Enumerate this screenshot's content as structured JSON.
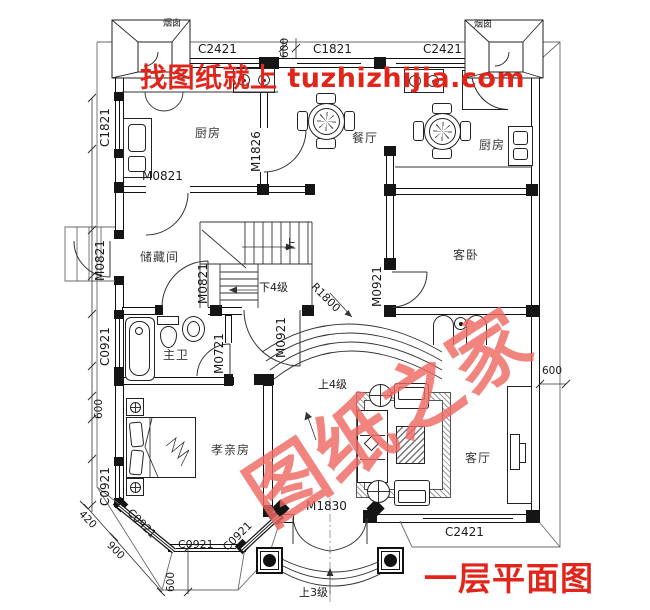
{
  "banner": {
    "text": "找图纸就上 tuzhizhijia.com"
  },
  "title": {
    "text": "一层平面图"
  },
  "watermark": {
    "text": "图纸之家"
  },
  "colors": {
    "red": "#e1251b",
    "watermark_red": "#ee6a63",
    "line": "#1a1a1a"
  },
  "labels": [
    {
      "n": "chimney-left-label",
      "t": "烟囱",
      "x": 163,
      "y": 20,
      "s": 9
    },
    {
      "n": "window-c2421-top-left",
      "t": "C2421",
      "x": 198,
      "y": 43,
      "s": 12
    },
    {
      "n": "dim-600-top",
      "t": "600",
      "x": 280,
      "y": 58,
      "r": -90,
      "s": 10.5
    },
    {
      "n": "window-c1821-top",
      "t": "C1821",
      "x": 313,
      "y": 43,
      "s": 12
    },
    {
      "n": "window-c2421-top-right",
      "t": "C2421",
      "x": 423,
      "y": 43,
      "s": 12
    },
    {
      "n": "chimney-right-label",
      "t": "烟囱",
      "x": 474,
      "y": 21,
      "s": 9
    },
    {
      "n": "window-c1821-left",
      "t": "C1821",
      "x": 99,
      "y": 147,
      "r": -90,
      "s": 12
    },
    {
      "n": "door-m0821-kitchen",
      "t": "M0821",
      "x": 142,
      "y": 170,
      "s": 12
    },
    {
      "n": "door-m1826-kitchen-dining",
      "t": "M1826",
      "x": 250,
      "y": 172,
      "r": -90,
      "s": 12
    },
    {
      "n": "room-kitchen-left",
      "t": "厨房",
      "x": 195,
      "y": 127,
      "s": 12,
      "c": "room"
    },
    {
      "n": "room-dining",
      "t": "餐厅",
      "x": 352,
      "y": 132,
      "s": 12,
      "c": "room"
    },
    {
      "n": "room-kitchen-right",
      "t": "厨房",
      "x": 479,
      "y": 139,
      "s": 12,
      "c": "room"
    },
    {
      "n": "door-m0821-side",
      "t": "M0821",
      "x": 94,
      "y": 281,
      "r": -90,
      "s": 12
    },
    {
      "n": "room-storage",
      "t": "储藏间",
      "x": 140,
      "y": 251,
      "s": 12,
      "c": "room"
    },
    {
      "n": "stairs-up-label",
      "t": "上",
      "x": 284,
      "y": 238,
      "s": 12
    },
    {
      "n": "stairs-down-4",
      "t": "下4级",
      "x": 259,
      "y": 282,
      "s": 11
    },
    {
      "n": "door-m0821-storage",
      "t": "M0821",
      "x": 197,
      "y": 304,
      "r": -90,
      "s": 12
    },
    {
      "n": "room-guest-bedroom",
      "t": "客卧",
      "x": 453,
      "y": 249,
      "s": 12,
      "c": "room"
    },
    {
      "n": "door-m0921-guest",
      "t": "M0921",
      "x": 371,
      "y": 307,
      "r": -90,
      "s": 12
    },
    {
      "n": "radius-r1800",
      "t": "R1800",
      "x": 317,
      "y": 281,
      "r": 45,
      "s": 11
    },
    {
      "n": "door-m0921-hall",
      "t": "M0921",
      "x": 275,
      "y": 358,
      "r": -90,
      "s": 12
    },
    {
      "n": "window-c0921-left-upper",
      "t": "C0921",
      "x": 99,
      "y": 366,
      "r": -90,
      "s": 12
    },
    {
      "n": "room-master-bath",
      "t": "主卫",
      "x": 163,
      "y": 349,
      "s": 12,
      "c": "room"
    },
    {
      "n": "door-m0721-bath",
      "t": "M0721",
      "x": 213,
      "y": 374,
      "r": -90,
      "s": 12
    },
    {
      "n": "steps-up-4",
      "t": "上4级",
      "x": 318,
      "y": 379,
      "s": 11
    },
    {
      "n": "dim-600-left",
      "t": "600",
      "x": 94,
      "y": 419,
      "r": -90,
      "s": 10.5
    },
    {
      "n": "room-parents-bedroom",
      "t": "孝亲房",
      "x": 211,
      "y": 444,
      "s": 12,
      "c": "room"
    },
    {
      "n": "room-living",
      "t": "客厅",
      "x": 465,
      "y": 452,
      "s": 12,
      "c": "room"
    },
    {
      "n": "window-c0921-left-lower",
      "t": "C0921",
      "x": 99,
      "y": 506,
      "r": -90,
      "s": 12
    },
    {
      "n": "dim-420",
      "t": "420",
      "x": 84,
      "y": 509,
      "r": 45,
      "s": 10.5
    },
    {
      "n": "dim-900",
      "t": "900",
      "x": 112,
      "y": 540,
      "r": 45,
      "s": 10.5
    },
    {
      "n": "window-c0921-bay-left",
      "t": "C0921",
      "x": 133,
      "y": 507,
      "r": 45,
      "s": 11
    },
    {
      "n": "window-c0921-bay-bottom",
      "t": "C0921",
      "x": 178,
      "y": 539,
      "s": 11
    },
    {
      "n": "window-c0921-bay-right",
      "t": "C0921",
      "x": 221,
      "y": 545,
      "r": -45,
      "s": 11
    },
    {
      "n": "dim-600-bay",
      "t": "600",
      "x": 166,
      "y": 592,
      "r": -90,
      "s": 10.5
    },
    {
      "n": "door-m1830-entry",
      "t": "M1830",
      "x": 306,
      "y": 500,
      "s": 12
    },
    {
      "n": "steps-up-3",
      "t": "上3级",
      "x": 299,
      "y": 587,
      "s": 11
    },
    {
      "n": "window-c2421-bottom",
      "t": "C2421",
      "x": 445,
      "y": 526,
      "s": 12
    },
    {
      "n": "dim-600-right",
      "t": "600",
      "x": 542,
      "y": 366,
      "s": 10.5
    }
  ]
}
